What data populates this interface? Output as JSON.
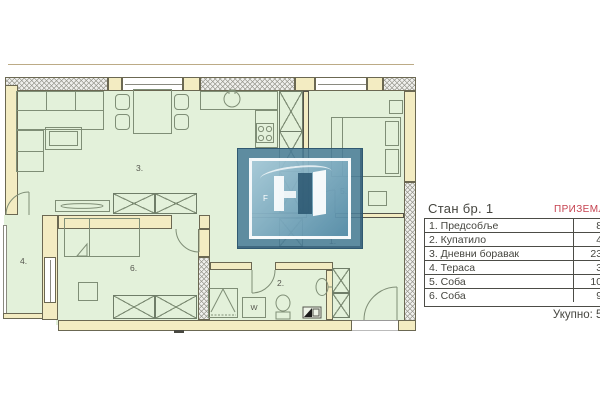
{
  "colors": {
    "wall_fill": "#f3ecc2",
    "room_fill": "#e3f1da",
    "plan_line": "#7f8e76",
    "accent_red": "#c5404e",
    "watermark_blue": "#497c98",
    "text": "#45453f"
  },
  "panel": {
    "apartment_title": "Стан бр. 1",
    "floor_label": "ПРИЗЕМЉЕ",
    "rows": [
      {
        "name": "1. Предсобље",
        "area": "8,"
      },
      {
        "name": "2. Купатило",
        "area": "4,"
      },
      {
        "name": "3. Дневни боравак",
        "area": "23,"
      },
      {
        "name": "4. Тераса",
        "area": "3,"
      },
      {
        "name": "5. Соба",
        "area": "10,"
      },
      {
        "name": "6. Соба",
        "area": "9,"
      }
    ],
    "total_label": "Укупно:",
    "total_value": "59,"
  },
  "floorplan": {
    "room_labels": [
      {
        "text": "1."
      },
      {
        "text": "2."
      },
      {
        "text": "3."
      },
      {
        "text": "4."
      },
      {
        "text": "5."
      },
      {
        "text": "6."
      }
    ],
    "washer_label": "W",
    "watermark_letter": "F"
  }
}
